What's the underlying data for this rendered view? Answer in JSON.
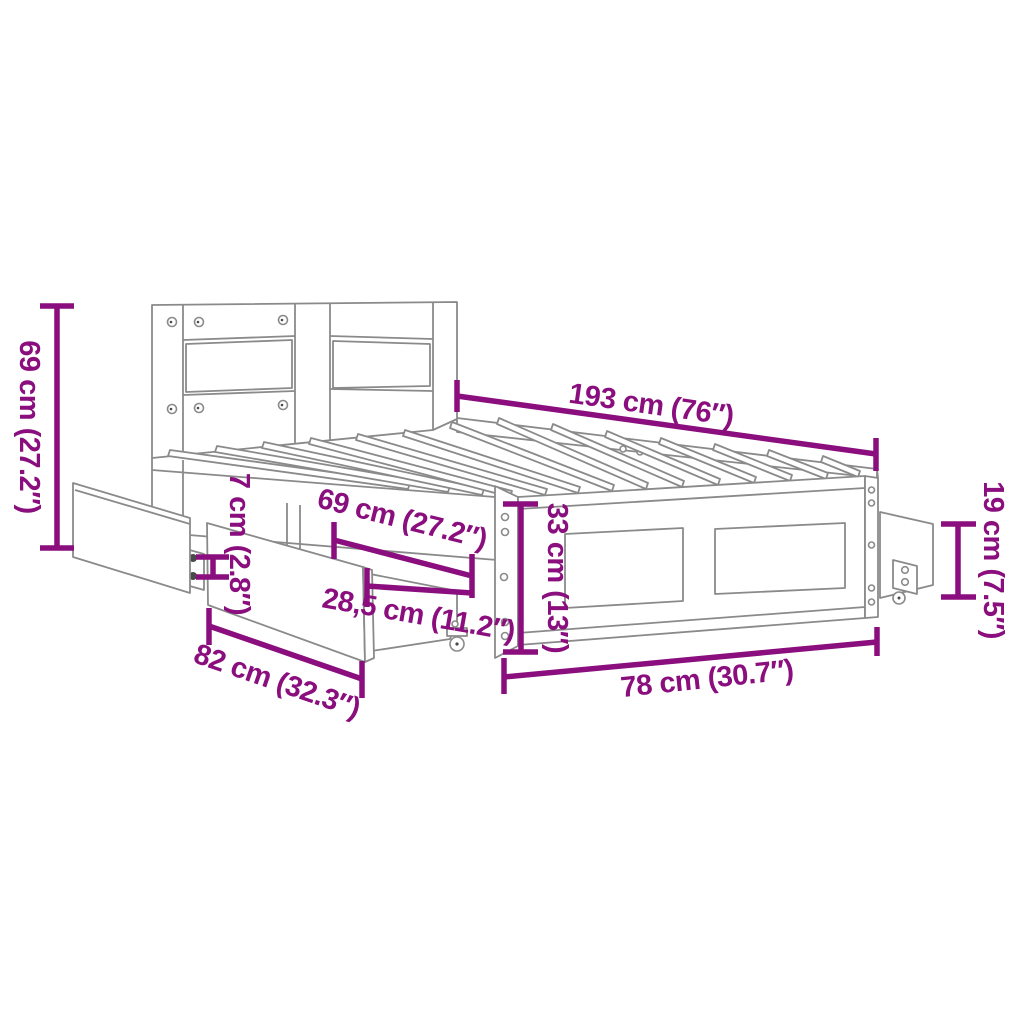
{
  "diagram": {
    "type": "product-dimension-diagram",
    "subject": "bed frame with headboard and pull-out storage drawers",
    "colors": {
      "dimension_accent": "#8A0E7D",
      "line_art": "#8A8A8A",
      "background": "#FFFFFF"
    },
    "labels": {
      "headboard_height": "69 cm (27.2″)",
      "bed_length": "193 cm (76″)",
      "drawer_gap": "7 cm (2.8″)",
      "drawer_length": "69 cm (27.2″)",
      "frame_height": "33 cm (13″)",
      "foot_drawer_height": "19 cm (7.5″)",
      "drawer_depth": "28,5 cm (11.2″)",
      "side_drawer_width": "82 cm (32.3″)",
      "bed_width": "78 cm (30.7″)"
    }
  }
}
